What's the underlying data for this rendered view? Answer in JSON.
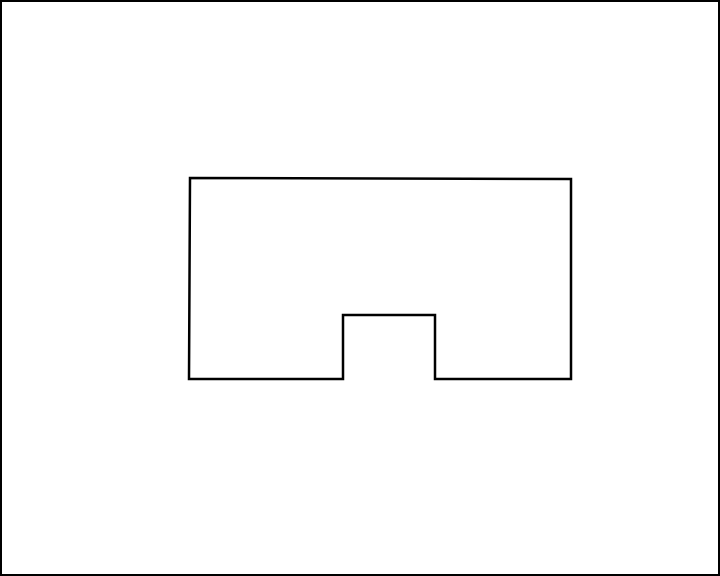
{
  "canvas": {
    "width": 720,
    "height": 576,
    "background_color": "#ffffff",
    "border_color": "#000000",
    "border_width_px": 2
  },
  "shape": {
    "name": "rectangle-with-bottom-center-notch",
    "type": "polygon",
    "stroke_color": "#000000",
    "stroke_width": 2.5,
    "fill": "none",
    "points": [
      [
        190,
        178
      ],
      [
        571,
        179
      ],
      [
        571,
        379
      ],
      [
        435,
        379
      ],
      [
        435,
        315
      ],
      [
        343,
        315
      ],
      [
        343,
        379
      ],
      [
        189,
        379
      ]
    ],
    "points_attr": "190,178 571,179 571,379 435,379 435,315 343,315 343,379 189,379"
  }
}
